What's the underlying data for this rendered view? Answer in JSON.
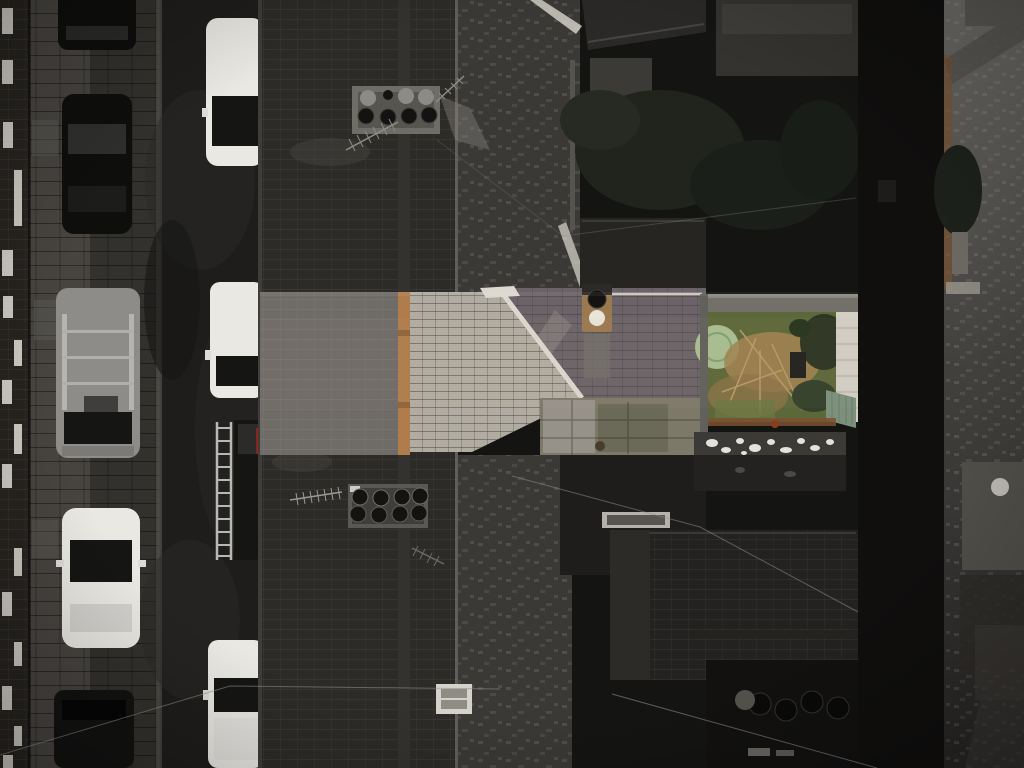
{
  "scene": {
    "type": "aerial-drone-photograph",
    "description": "Top-down drone photograph of a terraced street. Most of the scene is darkened monochrome; a bright horizontal strip across the middle highlights one property: its slate roof with an orange ridge board, a pale weathered tiled roof, a brick chimney with one black and one white pot, and an overgrown colour rear garden with a round green feature, white path and green gate. Cars are parked along the street at left; dark rooftops, back yards and rear terraces fill the right.",
    "highlight_region": {
      "x": 260,
      "y": 292,
      "width": 598,
      "height": 163
    }
  },
  "inventory": {
    "vehicles_left_row": [
      "black car (partial, top)",
      "black car",
      "grey van with roof rack",
      "white car",
      "dark car (partial, bottom)"
    ],
    "vehicles_right_row": [
      "white car",
      "white van",
      "dark van with red tail light",
      "white van (bottom)"
    ],
    "street_objects": [
      "ladder lying on road"
    ],
    "roof_objects": [
      "chimney stack with 8 pots (top)",
      "chimney stack with 8 pots (middle)",
      "highlighted-house chimney with black pot and white pot",
      "tv aerial x4",
      "skylight x2",
      "shed roof with white patches",
      "wheelie bins in back yard"
    ],
    "garden_features": [
      "overgrown lawn",
      "dead brown shrub",
      "round pale-green feature",
      "white paved path",
      "green gate",
      "dark bushes"
    ]
  },
  "palette": {
    "bg": "#141413",
    "facade": "#26231f",
    "window_white": "#ddd9d3",
    "sidewalk": "#474440",
    "setts": "#33312d",
    "kerb": "#55524d",
    "asphalt": "#1e1d1b",
    "roof_dark": "#2c2b28",
    "roof_mottled": "#3a3936",
    "valley": "#8a8780",
    "band_slate": "#6f6b67",
    "band_ridge": "#b07c4c",
    "band_roof_light": "#b1aca2",
    "band_roof_mid": "#6b6367",
    "ridge_white": "#dcd8d0",
    "chimney_tan": "#9b7950",
    "pot_dark": "#141312",
    "pot_light": "#e8e4d9",
    "garden_green": "#5c683a",
    "garden_brown": "#a1834f",
    "garden_dark": "#2c3623",
    "circle_green": "#a9bd92",
    "path_light": "#d2cfc5",
    "fence_green": "#7c907c",
    "wall_grey": "#73706a",
    "rust": "#7a5130",
    "car_white": "#e9e8e3",
    "car_black": "#0e0e0d",
    "van_grey": "#8d8c88",
    "glass": "#151514",
    "red_tail": "#8a2420",
    "ladder": "#b8b7b3",
    "wire": "#8f8d86",
    "blob_white": "#e5e2da",
    "shed_dark": "#3b3a37",
    "yard_stone": "#7d7969"
  }
}
